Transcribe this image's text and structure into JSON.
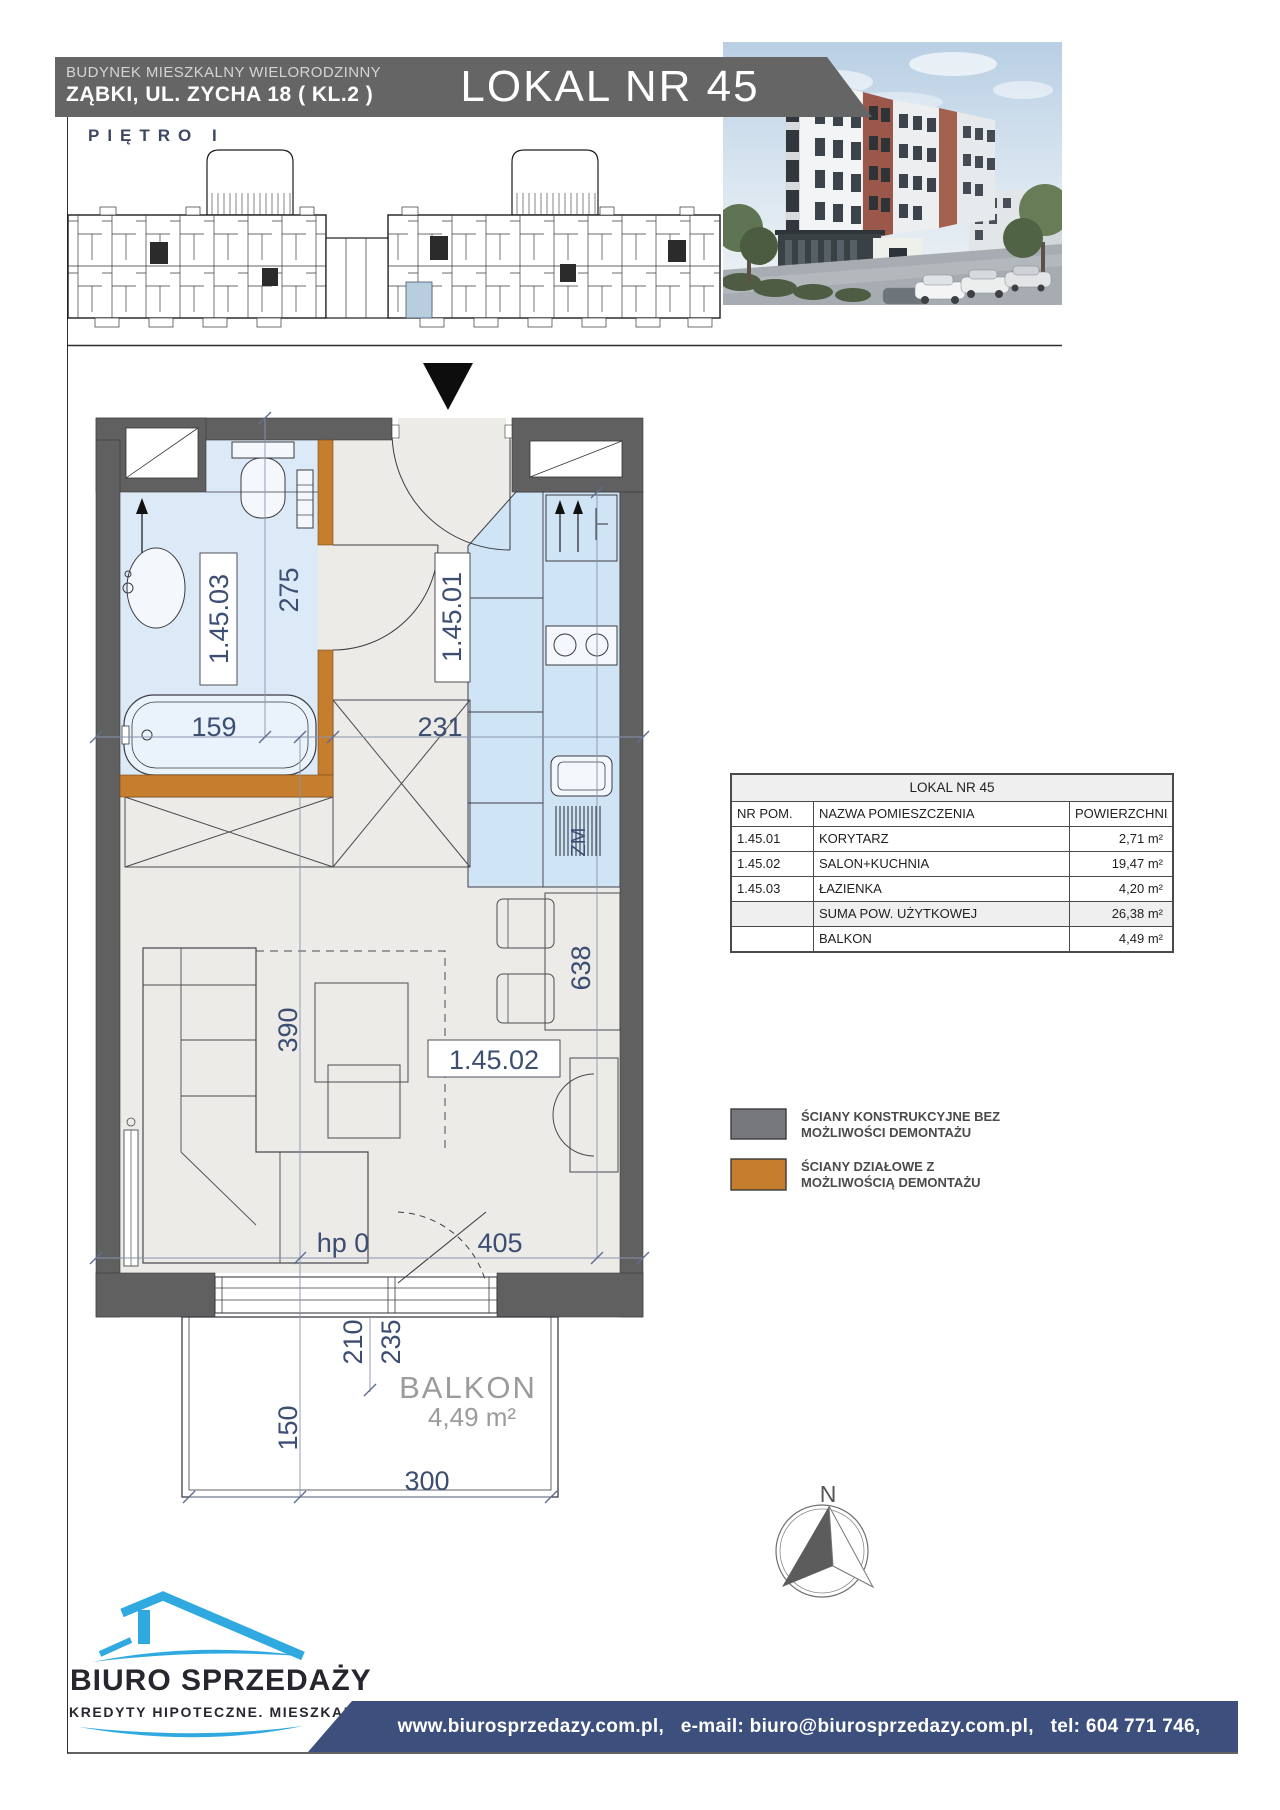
{
  "header": {
    "building_type": "BUDYNEK MIESZKALNY WIELORODZINNY",
    "address": "ZĄBKI, UL. ZYCHA 18 ( KL.2 )",
    "unit_title": "LOKAL NR 45",
    "floor_label": "PIĘTRO  I"
  },
  "floor_plan": {
    "rooms": {
      "hall": "1.45.01",
      "living": "1.45.02",
      "bath": "1.45.03"
    },
    "dims": {
      "bath_depth": "275",
      "bathtub": "159",
      "hall_width": "231",
      "living_depth": "390",
      "apartment_depth": "638",
      "living_width": "405",
      "sill": "hp 0",
      "door_a": "210",
      "door_b": "235",
      "balcony_depth": "150",
      "balcony_width": "300"
    },
    "appliances": {
      "dishwasher": "ZM"
    },
    "balcony": {
      "label": "BALKON",
      "area": "4,49 m²"
    }
  },
  "area_table": {
    "title": "LOKAL NR 45",
    "columns": [
      "NR POM.",
      "NAZWA POMIESZCZENIA",
      "POWIERZCHNIA"
    ],
    "rows": [
      {
        "nr": "1.45.01",
        "name": "KORYTARZ",
        "area": "2,71 m²"
      },
      {
        "nr": "1.45.02",
        "name": "SALON+KUCHNIA",
        "area": "19,47 m²"
      },
      {
        "nr": "1.45.03",
        "name": "ŁAZIENKA",
        "area": "4,20 m²"
      }
    ],
    "total": {
      "name": "SUMA POW. UŻYTKOWEJ",
      "area": "26,38 m²"
    },
    "balcony": {
      "name": "BALKON",
      "area": "4,49 m²"
    }
  },
  "legend": {
    "structural": {
      "color": "#77787B",
      "line1": "ŚCIANY KONSTRUKCYJNE BEZ",
      "line2": "MOŻLIWOŚCI DEMONTAŻU"
    },
    "partition": {
      "color": "#C57D2E",
      "line1": "ŚCIANY DZIAŁOWE Z",
      "line2": "MOŻLIWOŚCIĄ DEMONTAŻU"
    }
  },
  "compass": {
    "north": "N"
  },
  "branding": {
    "name": "BIURO SPRZEDAŻY",
    "tagline": "KREDYTY HIPOTECZNE. MIESZKANIA"
  },
  "footer": {
    "contact": "www.biurosprzedazy.com.pl,   e-mail: biuro@biurosprzedazy.com.pl,   tel: 604 771 746,"
  },
  "colors": {
    "accent_orange": "#C57D2E",
    "wall_gray": "#606060",
    "plan_text_blue": "#3D4E73",
    "logo_blue": "#2FA9E0",
    "footer_navy": "#3D4F7C",
    "highlight_unit": "#B7CEDE"
  }
}
